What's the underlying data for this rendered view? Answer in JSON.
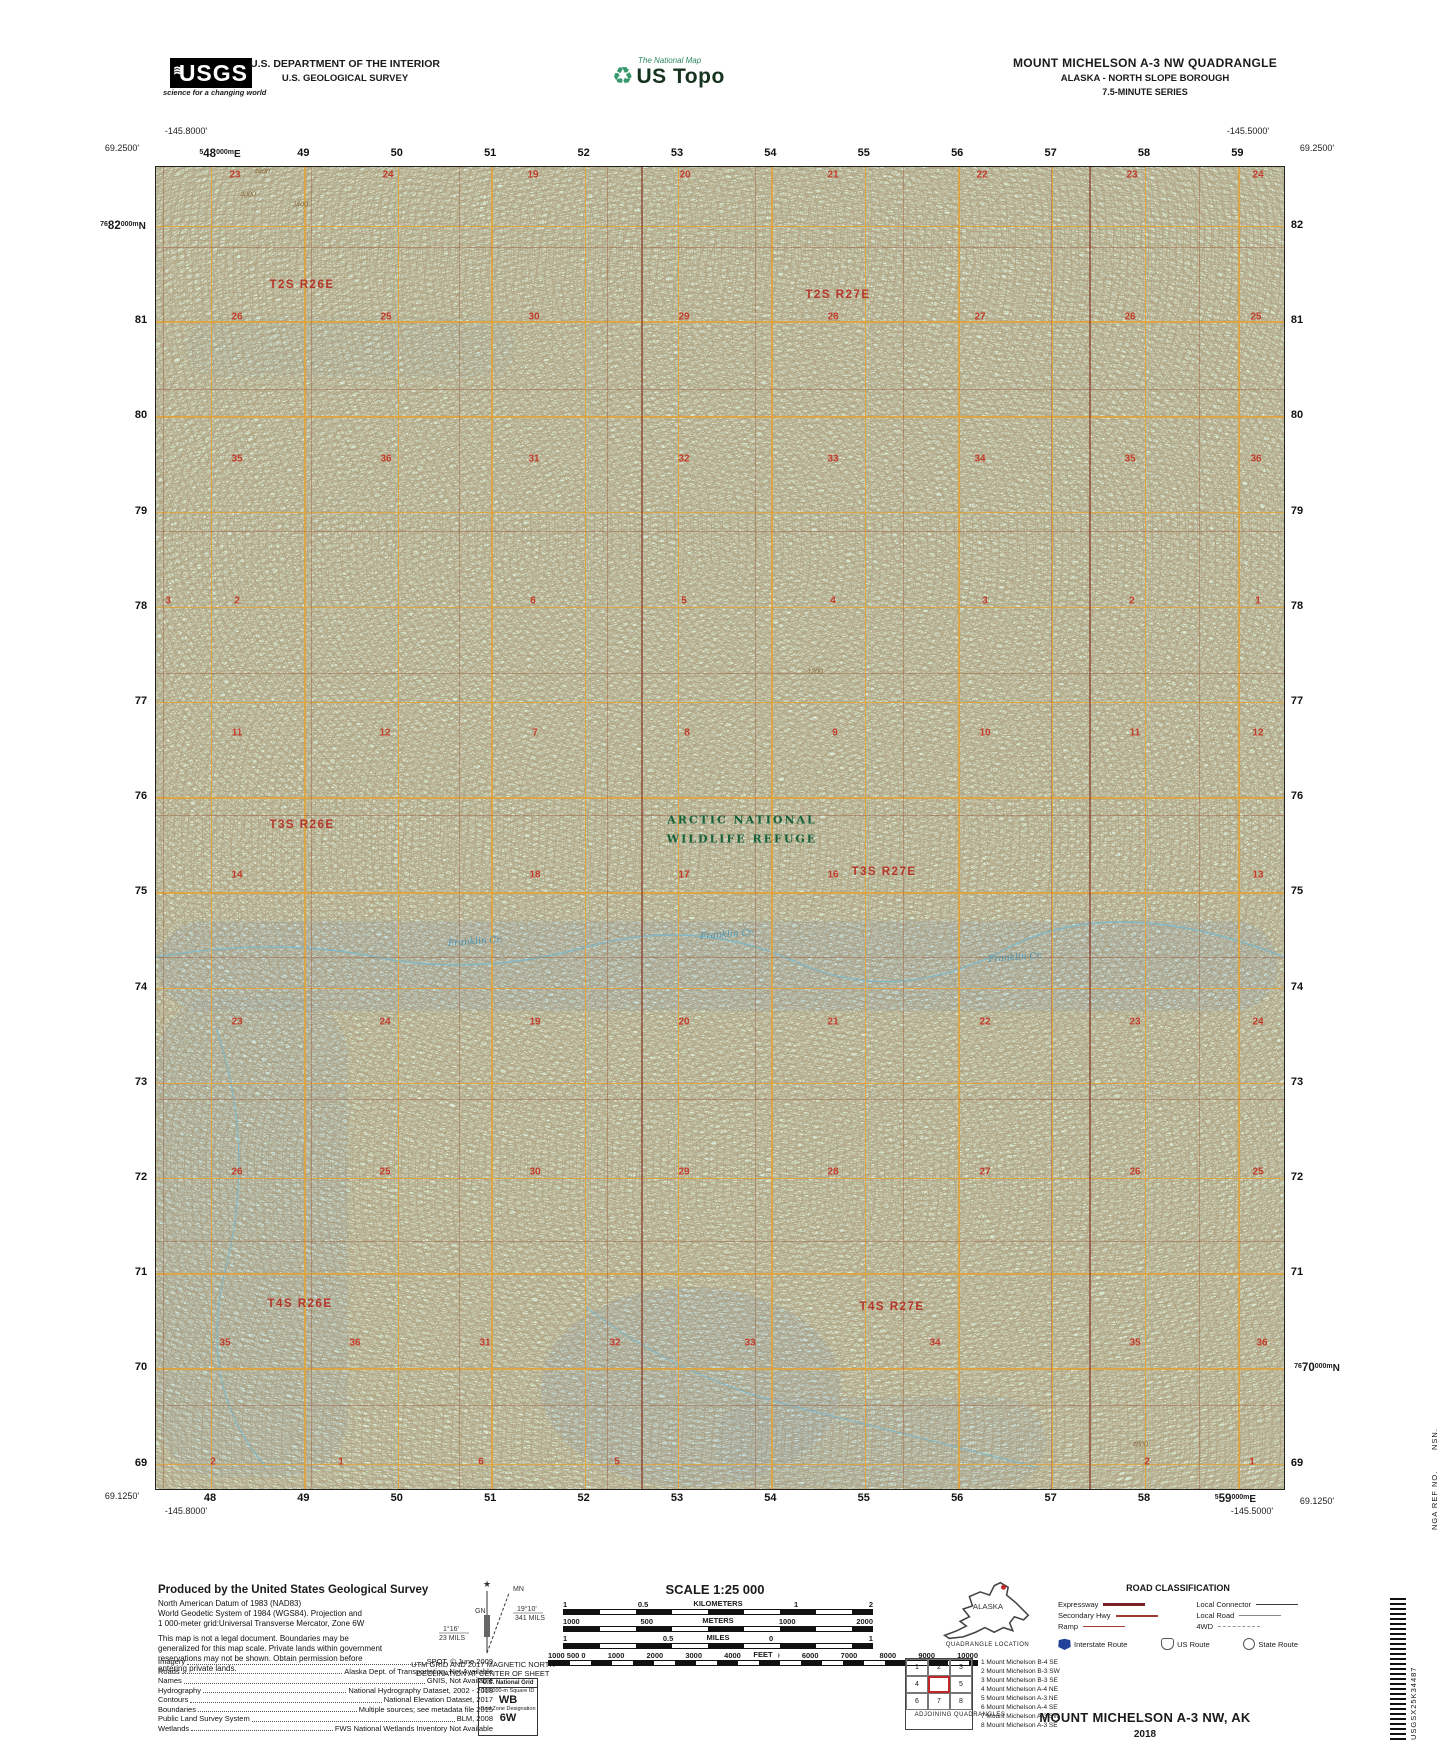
{
  "header": {
    "usgs_logo": {
      "text": "USGS",
      "waves": "≋",
      "tagline": "science for a changing world"
    },
    "dept_line1": "U.S. DEPARTMENT OF THE INTERIOR",
    "dept_line2": "U.S. GEOLOGICAL SURVEY",
    "ustopo_logo": {
      "tagline": "The National Map",
      "glyph": "♻",
      "title": "US Topo"
    },
    "quad_title": "MOUNT MICHELSON A-3 NW QUADRANGLE",
    "quad_subtitle1": "ALASKA - NORTH SLOPE BOROUGH",
    "quad_subtitle2": "7.5-MINUTE SERIES"
  },
  "map": {
    "corners": {
      "top_left_lon": "-145.8000'",
      "top_left_lat": "69.2500'",
      "top_right_lon": "-145.5000'",
      "top_right_lat": "69.2500'",
      "bottom_left_lat": "69.1250'",
      "bottom_left_lon": "-145.8000'",
      "bottom_right_lon": "-145.5000'",
      "bottom_right_lat": "69.1250'"
    },
    "eastings": [
      "48",
      "49",
      "50",
      "51",
      "52",
      "53",
      "54",
      "55",
      "56",
      "57",
      "58",
      "59"
    ],
    "easting_first": {
      "sup": "5",
      "main": "48",
      "unit": "000m",
      "suffix": "E"
    },
    "easting_last": {
      "sup": "5",
      "main": "59",
      "unit": "000m",
      "suffix": "E"
    },
    "northings": [
      "82",
      "81",
      "80",
      "79",
      "78",
      "77",
      "76",
      "75",
      "74",
      "73",
      "72",
      "71",
      "70",
      "69"
    ],
    "northing_first": {
      "sup": "76",
      "main": "82",
      "unit": "000m",
      "suffix": "N"
    },
    "northing_70": {
      "sup": "76",
      "main": "70",
      "unit": "000m",
      "suffix": "N"
    },
    "townships": [
      {
        "x": 302,
        "y": 285,
        "label": "T2S R26E"
      },
      {
        "x": 838,
        "y": 295,
        "label": "T2S R27E"
      },
      {
        "x": 302,
        "y": 825,
        "label": "T3S R26E"
      },
      {
        "x": 884,
        "y": 872,
        "label": "T3S R27E"
      },
      {
        "x": 300,
        "y": 1304,
        "label": "T4S R26E"
      },
      {
        "x": 892,
        "y": 1307,
        "label": "T4S R27E"
      }
    ],
    "refuge_label": [
      "ARCTIC NATIONAL",
      "WILDLIFE REFUGE"
    ],
    "refuge_pos": {
      "x": 742,
      "y1": 820,
      "y2": 839
    },
    "creek_labels": [
      {
        "x": 448,
        "y": 937,
        "label": "Franklin Cr."
      },
      {
        "x": 700,
        "y": 930,
        "label": "Franklin Cr."
      },
      {
        "x": 988,
        "y": 953,
        "label": "Franklin Cr."
      }
    ],
    "contour_labels": [
      {
        "x": 262,
        "y": 172,
        "label": "4400"
      },
      {
        "x": 248,
        "y": 195,
        "label": "4000"
      },
      {
        "x": 300,
        "y": 205,
        "label": "3400"
      },
      {
        "x": 815,
        "y": 672,
        "label": "1200"
      },
      {
        "x": 1140,
        "y": 1445,
        "label": "4800"
      }
    ],
    "sections": [
      {
        "y": 175,
        "items": [
          {
            "x": 235,
            "n": "23"
          },
          {
            "x": 388,
            "n": "24"
          },
          {
            "x": 533,
            "n": "19"
          },
          {
            "x": 685,
            "n": "20"
          },
          {
            "x": 833,
            "n": "21"
          },
          {
            "x": 982,
            "n": "22"
          },
          {
            "x": 1132,
            "n": "23"
          },
          {
            "x": 1258,
            "n": "24"
          }
        ]
      },
      {
        "y": 317,
        "items": [
          {
            "x": 237,
            "n": "26"
          },
          {
            "x": 386,
            "n": "25"
          },
          {
            "x": 534,
            "n": "30"
          },
          {
            "x": 684,
            "n": "29"
          },
          {
            "x": 833,
            "n": "28"
          },
          {
            "x": 980,
            "n": "27"
          },
          {
            "x": 1130,
            "n": "26"
          },
          {
            "x": 1256,
            "n": "25"
          }
        ]
      },
      {
        "y": 459,
        "items": [
          {
            "x": 237,
            "n": "35"
          },
          {
            "x": 386,
            "n": "36"
          },
          {
            "x": 534,
            "n": "31"
          },
          {
            "x": 684,
            "n": "32"
          },
          {
            "x": 833,
            "n": "33"
          },
          {
            "x": 980,
            "n": "34"
          },
          {
            "x": 1130,
            "n": "35"
          },
          {
            "x": 1256,
            "n": "36"
          }
        ]
      },
      {
        "y": 601,
        "items": [
          {
            "x": 168,
            "n": "3"
          },
          {
            "x": 237,
            "n": "2"
          },
          {
            "x": 533,
            "n": "6"
          },
          {
            "x": 684,
            "n": "5"
          },
          {
            "x": 833,
            "n": "4"
          },
          {
            "x": 985,
            "n": "3"
          },
          {
            "x": 1132,
            "n": "2"
          },
          {
            "x": 1258,
            "n": "1"
          }
        ]
      },
      {
        "y": 733,
        "items": [
          {
            "x": 237,
            "n": "11"
          },
          {
            "x": 385,
            "n": "12"
          },
          {
            "x": 535,
            "n": "7"
          },
          {
            "x": 687,
            "n": "8"
          },
          {
            "x": 835,
            "n": "9"
          },
          {
            "x": 985,
            "n": "10"
          },
          {
            "x": 1135,
            "n": "11"
          },
          {
            "x": 1258,
            "n": "12"
          }
        ]
      },
      {
        "y": 875,
        "items": [
          {
            "x": 237,
            "n": "14"
          },
          {
            "x": 535,
            "n": "18"
          },
          {
            "x": 684,
            "n": "17"
          },
          {
            "x": 833,
            "n": "16"
          },
          {
            "x": 1258,
            "n": "13"
          }
        ]
      },
      {
        "y": 1022,
        "items": [
          {
            "x": 237,
            "n": "23"
          },
          {
            "x": 385,
            "n": "24"
          },
          {
            "x": 535,
            "n": "19"
          },
          {
            "x": 684,
            "n": "20"
          },
          {
            "x": 833,
            "n": "21"
          },
          {
            "x": 985,
            "n": "22"
          },
          {
            "x": 1135,
            "n": "23"
          },
          {
            "x": 1258,
            "n": "24"
          }
        ]
      },
      {
        "y": 1172,
        "items": [
          {
            "x": 237,
            "n": "26"
          },
          {
            "x": 385,
            "n": "25"
          },
          {
            "x": 535,
            "n": "30"
          },
          {
            "x": 684,
            "n": "29"
          },
          {
            "x": 833,
            "n": "28"
          },
          {
            "x": 985,
            "n": "27"
          },
          {
            "x": 1135,
            "n": "26"
          },
          {
            "x": 1258,
            "n": "25"
          }
        ]
      },
      {
        "y": 1343,
        "items": [
          {
            "x": 225,
            "n": "35"
          },
          {
            "x": 355,
            "n": "36"
          },
          {
            "x": 485,
            "n": "31"
          },
          {
            "x": 615,
            "n": "32"
          },
          {
            "x": 750,
            "n": "33"
          },
          {
            "x": 935,
            "n": "34"
          },
          {
            "x": 1135,
            "n": "35"
          },
          {
            "x": 1262,
            "n": "36"
          }
        ]
      },
      {
        "y": 1462,
        "items": [
          {
            "x": 213,
            "n": "2"
          },
          {
            "x": 341,
            "n": "1"
          },
          {
            "x": 481,
            "n": "6"
          },
          {
            "x": 617,
            "n": "5"
          },
          {
            "x": 1147,
            "n": "2"
          },
          {
            "x": 1252,
            "n": "1"
          }
        ]
      }
    ],
    "colors": {
      "base_green": "#d9e9d5",
      "water_blue": "#bbdbe5",
      "utm_grid": "#e0a33c",
      "section_line": "#9d5a3c",
      "label_red": "#c23b2b",
      "township_red": "#b5362a",
      "refuge_green": "#15603a",
      "contour_brown": "#92724a",
      "creek_blue": "#4792b4"
    }
  },
  "footer": {
    "produced_by": "Produced by the United States Geological Survey",
    "datum_lines": [
      "North American Datum of 1983 (NAD83)",
      "World Geodetic System of 1984 (WGS84).  Projection and",
      "1 000-meter grid:Universal Transverse Mercator, Zone 6W"
    ],
    "legal_lines": [
      "This map is not a legal document. Boundaries may be",
      "generalized for this map scale. Private lands within government",
      "reservations may not be shown. Obtain permission before",
      "entering private lands."
    ],
    "credits": [
      {
        "label": "Imagery",
        "value": "SPOT,  ©  June  2009"
      },
      {
        "label": "Roads",
        "value": "Alaska Dept. of Transportation, Not Available"
      },
      {
        "label": "Names",
        "value": "GNIS, Not Available"
      },
      {
        "label": "Hydrography",
        "value": "National Hydrography Dataset, 2002 - 2018"
      },
      {
        "label": "Contours",
        "value": "National Elevation Dataset, 2017"
      },
      {
        "label": "Boundaries",
        "value": "Multiple sources; see metadata file 2015"
      },
      {
        "label": "Public Land Survey System",
        "value": "BLM, 2008"
      },
      {
        "label": "Wetlands",
        "value": "FWS National Wetlands Inventory Not Available"
      }
    ],
    "declination": {
      "gn_label": "GN",
      "mn_label": "MN",
      "gn_deg": "1°16'",
      "gn_mils": "23 MILS",
      "mn_deg": "19°10'",
      "mn_mils": "341 MILS",
      "caption1": "UTM GRID AND 2017 MAGNETIC NORTH",
      "caption2": "DECLINATION AT CENTER OF SHEET"
    },
    "usng": {
      "title": "U.S. National Grid",
      "square_label": "100,000-m Square ID",
      "square": "WB",
      "zone_label": "Grid Zone Designation",
      "zone": "6W"
    },
    "scale": {
      "title": "SCALE 1:25 000",
      "bars": [
        {
          "unit": "KILOMETERS",
          "labels": [
            "1",
            "0.5",
            "0",
            "1",
            "2"
          ],
          "fine": false
        },
        {
          "unit": "METERS",
          "labels": [
            "1000",
            "500",
            "0",
            "1000",
            "2000"
          ],
          "fine": false
        },
        {
          "unit": "MILES",
          "labels": [
            "1",
            "0.5",
            "0",
            "1"
          ],
          "fine": false
        },
        {
          "unit": "FEET",
          "labels": [
            "1000 500 0",
            "1000",
            "2000",
            "3000",
            "4000",
            "5000",
            "6000",
            "7000",
            "8000",
            "9000",
            "10000"
          ],
          "fine": true
        }
      ]
    },
    "contour_note": [
      "CONTOUR INTERVAL 80 FEET",
      "NORTH AMERICAN VERTICAL DATUM OF 1988"
    ],
    "conformance": [
      "This map was produced to conform with the",
      "National Geospatial Program US Topo Product Standard, 2011.",
      "A metadata file associated with this product is draft version 0.6.17"
    ],
    "quadloc": {
      "state": "ALASKA",
      "caption": "QUADRANGLE LOCATION"
    },
    "adjoining": {
      "grid": [
        "1",
        "2",
        "3",
        "4",
        "",
        "5",
        "6",
        "7",
        "8"
      ],
      "list": [
        "1 Mount Michelson B-4 SE",
        "2 Mount Michelson B-3 SW",
        "3 Mount Michelson B-3 SE",
        "4 Mount Michelson A-4 NE",
        "5 Mount Michelson A-3 NE",
        "6 Mount Michelson A-4 SE",
        "7 Mount Michelson A-3 SW",
        "8 Mount Michelson A-3 SE"
      ],
      "caption": "ADJOINING QUADRANGLES"
    },
    "roads": {
      "title": "ROAD CLASSIFICATION",
      "left_rows": [
        {
          "label": "Expressway",
          "style": "expressway"
        },
        {
          "label": "Secondary Hwy",
          "style": "secondary"
        },
        {
          "label": "Ramp",
          "style": "ramp"
        }
      ],
      "right_rows": [
        {
          "label": "Local Connector",
          "style": "connector"
        },
        {
          "label": "Local Road",
          "style": "local"
        },
        {
          "label": "4WD",
          "style": "fourwd"
        }
      ],
      "shields": [
        {
          "label": "Interstate Route",
          "type": "interstate"
        },
        {
          "label": "US Route",
          "type": "us"
        },
        {
          "label": "State Route",
          "type": "state"
        }
      ]
    },
    "title_block": {
      "name": "MOUNT MICHELSON A-3 NW,  AK",
      "year": "2018"
    },
    "edge_codes": {
      "nsn": "NSN.",
      "nga": "NGA REF NO.",
      "code": "USGSX25K34487"
    }
  }
}
